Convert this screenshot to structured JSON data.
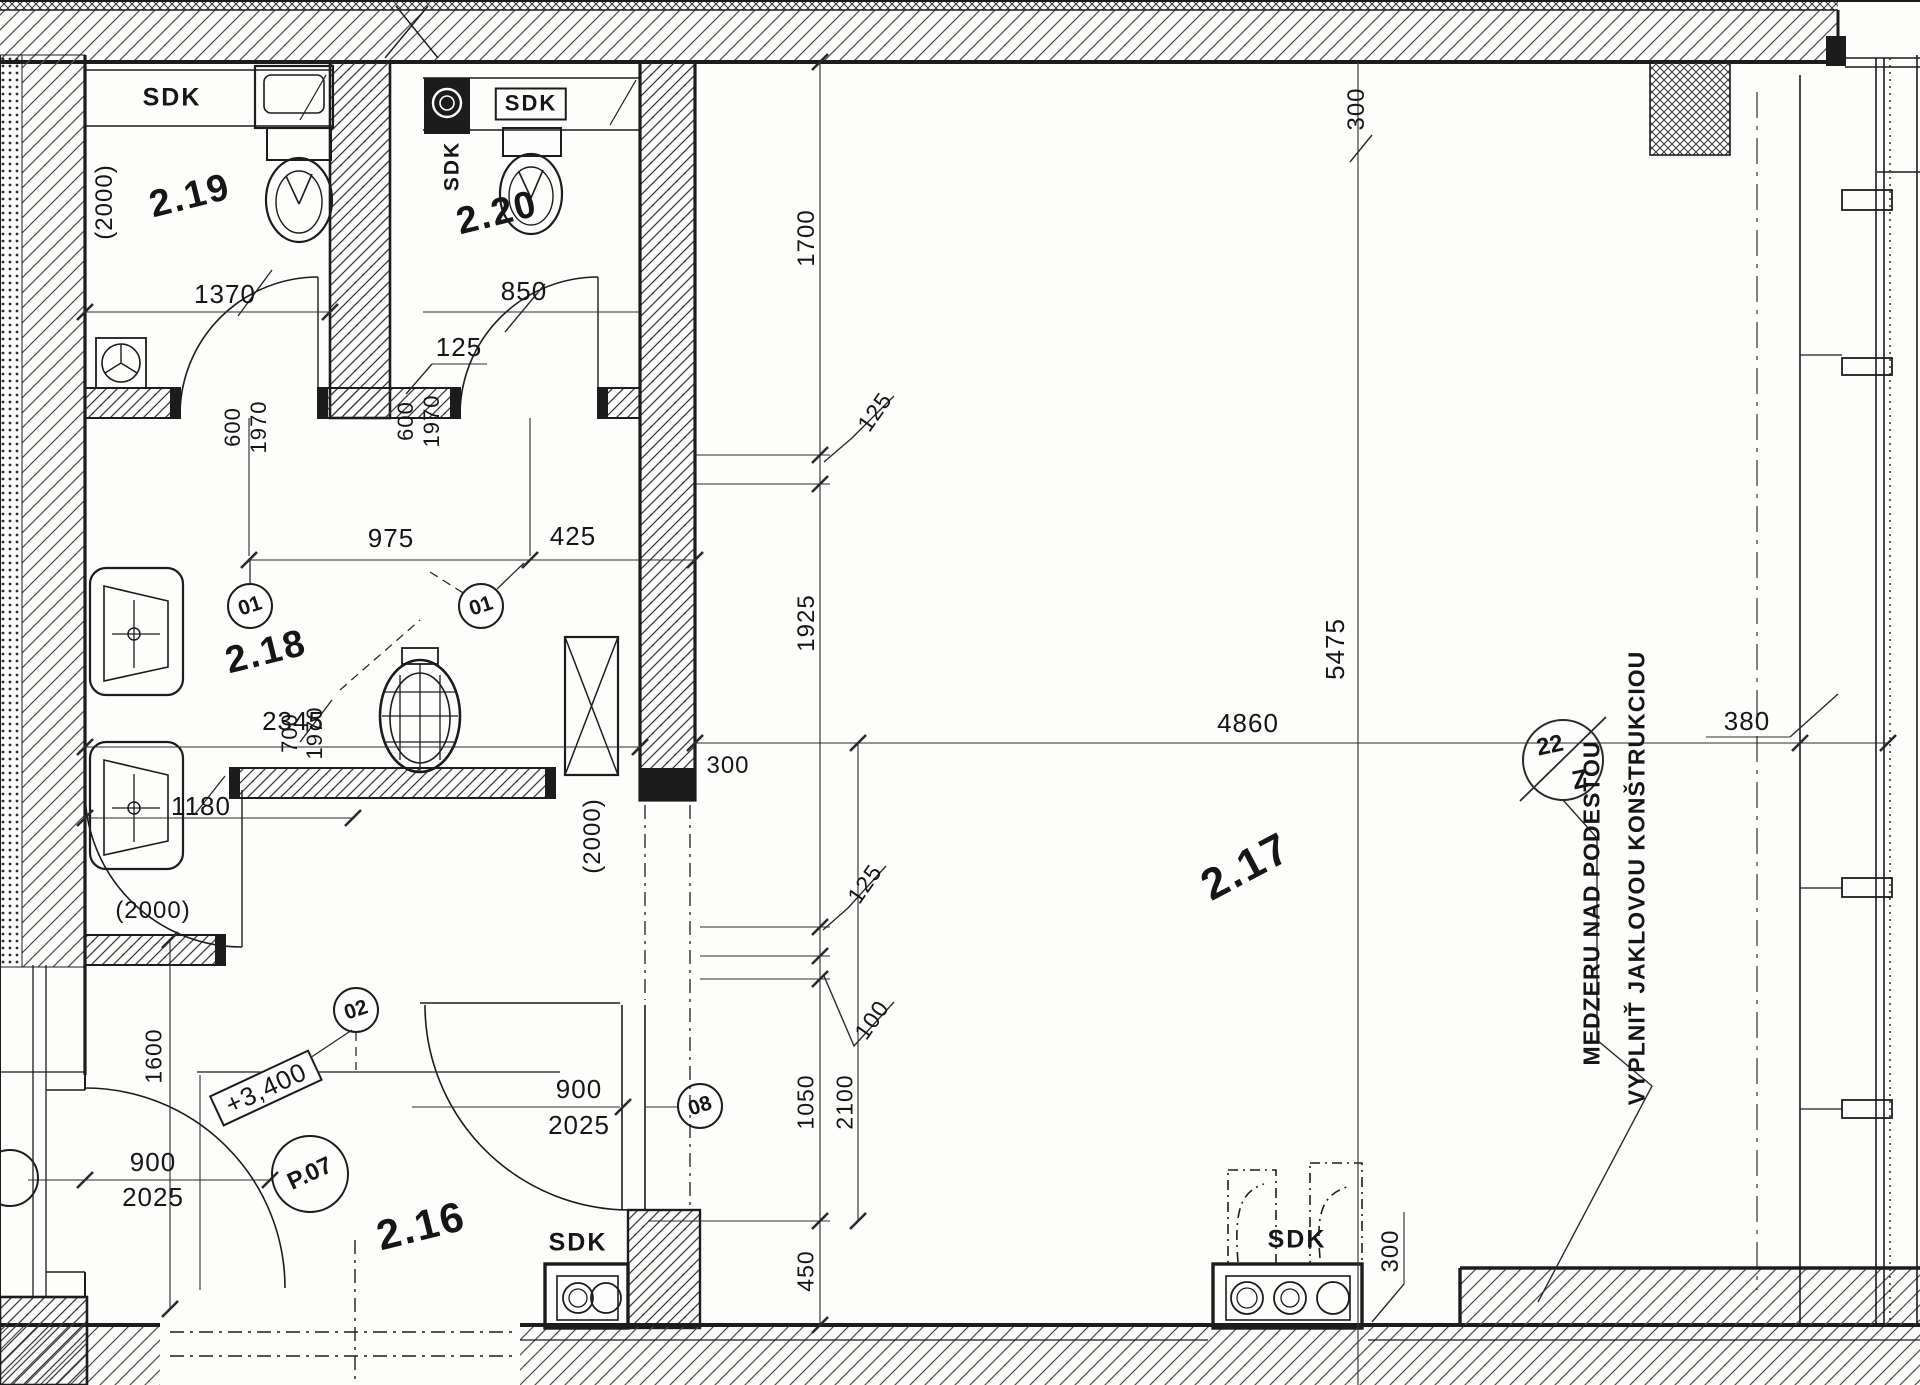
{
  "drawing_type": "architectural floor plan (scanned)",
  "rooms": {
    "r219": "2.19",
    "r220": "2.20",
    "r218": "2.18",
    "r216": "2.16",
    "r217": "2.17"
  },
  "sdk_labels": {
    "sdk_219": "SDK",
    "sdk_220_box": "SDK",
    "sdk_220_wall": "SDK",
    "sdk_216": "SDK",
    "sdk_217": "SDK"
  },
  "dimensions": {
    "p2000_219": "(2000)",
    "w1370": "1370",
    "h600_219": "600",
    "h1970_219": "1970",
    "w850": "850",
    "g125_220": "125",
    "h600_220": "600",
    "h1970_220": "1970",
    "w975": "975",
    "w425": "425",
    "w2345": "2345",
    "w1180": "1180",
    "p2000_218": "(2000)",
    "h700_216": "700",
    "h1970_216": "1970",
    "p2000_216": "(2000)",
    "h1600": "1600",
    "d900_p07": "900",
    "d2025_p07": "2025",
    "d900_08": "900",
    "d2025_08": "2025",
    "v1700": "1700",
    "v125_a": "125",
    "v1925": "1925",
    "w300_wall": "300",
    "w4860": "4860",
    "v5475": "5475",
    "v125_b": "125",
    "v100": "100",
    "v1050": "1050",
    "v2100": "2100",
    "v450": "450",
    "w380": "380",
    "v300_top": "300",
    "v300_bot": "300"
  },
  "levels": {
    "lvl_3400": "+3,400"
  },
  "door_tags": {
    "t01a": "01",
    "t01b": "01",
    "t02": "02",
    "t08": "08",
    "p07": "P.07"
  },
  "detail_marker": {
    "top": "22",
    "bottom": "Z"
  },
  "notes": {
    "note1": "MEDZERU NAD PODESTOU",
    "note2": "VYPLNIŤ JAKLOVOU KONŠTRUKCIOU"
  }
}
